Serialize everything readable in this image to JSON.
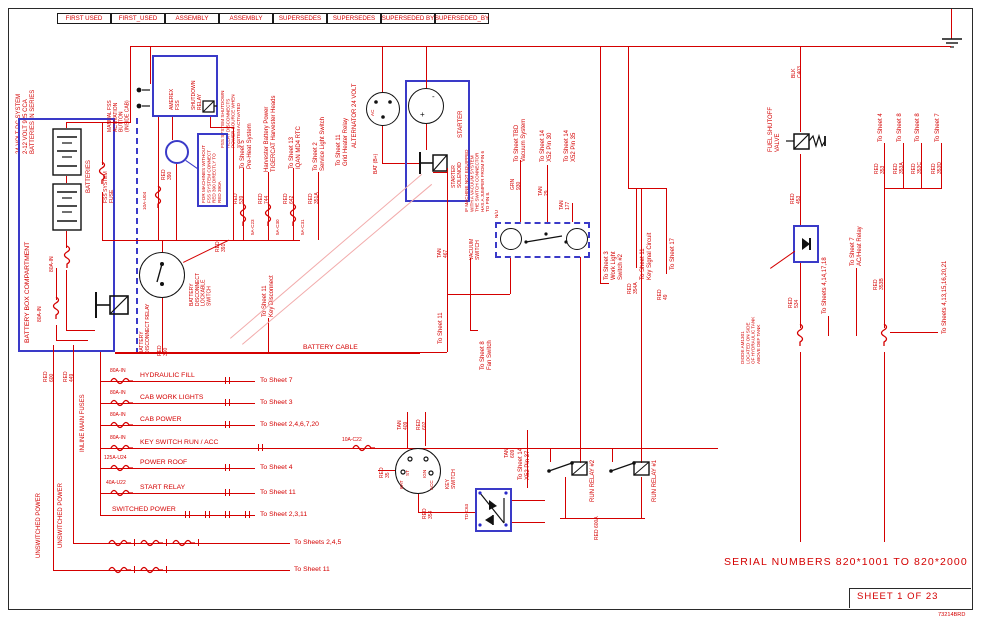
{
  "doc": {
    "serial": "SERIAL NUMBERS 820*1001 TO 820*2000",
    "sheet": "SHEET 1 OF 23",
    "number": "73214BRD"
  },
  "header": {
    "cells": [
      "FIRST USED",
      "FIRST_USED",
      "ASSEMBLY",
      "ASSEMBLY",
      "SUPERSEDES",
      "SUPERSEDES",
      "SUPERSEDED BY",
      "SUPERSEDED_BY"
    ]
  },
  "left": {
    "system": "24 VOLT DC SYSTEM\n2-12 VOLT 925 CCA\nBATTERIES IN SERIES",
    "battery_box": "BATTERY BOX COMPARTMENT",
    "batteries": "BATTERIES",
    "fss_fuse": "FSS SYSTEM\nFUSE",
    "fuse1": "80A-IN",
    "fuse2": "80A-IN",
    "disc_relay": "BATTERY\nDISCONNECT RELAY",
    "disc_switch": "BATTERY\nDISCONNECT\nLOCKABLE\nSWITCH",
    "key_disconnect": "To Sheet 11\nKey Disconnect",
    "battery_cable": "BATTERY CABLE",
    "unswitched1": "UNSWITCHED POWER",
    "unswitched2": "UNSWITCHED POWER",
    "inline_fuses": "INLINE MAIN FUSES",
    "red600": "RED\n600",
    "red449": "RED\n449"
  },
  "fss": {
    "manual_button": "MANUAL FSS\nACTIVATION\nBUTTON\n(INSIDE CAB)",
    "amerex": "AMEREX\nFSS",
    "shutdown_relay": "SHUTDOWN\nRELAY",
    "side_note": "FSS SYSTEM SHUTDOWN\nRELAY DISCONNECTS\nPOWER SOURCE WHEN\nSYSTEM ACTIVATED",
    "box_note": "FOR MACHINES WITHOUT\nFSS SYSTEM CONNECT\nRED 390 DIRECTLY TO\nRED 390A",
    "fuse": "10A-U04",
    "red390": "RED\n390"
  },
  "exits_top": [
    {
      "label": "To Sheet 5\nPre-Heat System",
      "wire": "RED\n539",
      "fuse": "5A-C23"
    },
    {
      "label": "Harvester Battery Power\nTIGERCAT Harvester Heads",
      "wire": "RED\n744",
      "fuse": "5A-C30"
    },
    {
      "label": "To Sheet 13\nIQAN MD4 RTC",
      "wire": "RED\n642",
      "fuse": "5A-C31"
    },
    {
      "label": "To Sheet 2\nService Light Switch",
      "wire": "RED\n351A",
      "fuse": ""
    }
  ],
  "engine": {
    "grid_heater": "To Sheet 11\nGrid Heater Relay",
    "alternator": "ALTERNATOR 24 VOLT",
    "bat": "BAT (B+)",
    "ac": "AC",
    "minus": "-",
    "plus": "+",
    "starter": "STARTER",
    "solenoid": "STARTER\nSOLENOID",
    "tan467": "TAN\n467",
    "to_sheet11": "To Sheet 11",
    "red391": "RED\n391"
  },
  "vacuum": {
    "note": "IF MACHINE NOT EQUIPPED\nWITH A VACUUM SYSTEM\nTHE SWITCH CONNECTOR\nHAS A JUMPER FROM PIN 6\nTO PIN 8.",
    "switch": "VACUUM\nSWITCH",
    "nu": "N/U",
    "tbd": "To Sheet TBD\nVacuum System",
    "grn930": "GRN\n930",
    "pin30": "To Sheet 14\nX52 Pin 30",
    "tan29": "TAN\n29",
    "pin35": "To Sheet 14\nX52 Pin 35",
    "tan177": "TAN\n177",
    "fan": "To Sheet 8\nFan Switch"
  },
  "mid_exits": [
    {
      "label": "To Sheet 3\nWork Light\nSwitch #2",
      "wire": ""
    },
    {
      "label": "To Sheet 11\nKey Signal Circuit",
      "wire": "RED\n354A"
    },
    {
      "label": "To Sheet 17",
      "wire": "RED\n49"
    }
  ],
  "fuel": {
    "valve": "FUEL SHUTOFF\nVALVE",
    "blk": "BLK\nC403",
    "red453": "RED\n453",
    "red534": "RED\n534",
    "diode_note": "DIODE AM1301\nLOCATED ON SIDE\nOF HYDRAULIC TANK\nABOVE DEF TANK",
    "sheets_a": "To Sheets 4,14,17,18",
    "ac_heat": "To Sheet 7\nAC/Heat Relay"
  },
  "exits_right": [
    {
      "label": "To Sheet 4",
      "wire": "RED\n353"
    },
    {
      "label": "To Sheet 8",
      "wire": "RED\n353A"
    },
    {
      "label": "To Sheet 8",
      "wire": "RED\n353C"
    },
    {
      "label": "To Sheet 7",
      "wire": "RED\n353D"
    }
  ],
  "right": {
    "red353b": "RED\n353B",
    "sheets_b": "To Sheets 4,13,15,16,20,21"
  },
  "fuses": {
    "rows": [
      {
        "amp": "80A-IN",
        "name": "HYDRAULIC FILL",
        "dest": "To Sheet 7"
      },
      {
        "amp": "80A-IN",
        "name": "CAB WORK LIGHTS",
        "dest": "To Sheet 3"
      },
      {
        "amp": "80A-IN",
        "name": "CAB POWER",
        "dest": "To Sheet 2,4,6,7,20"
      },
      {
        "amp": "80A-IN",
        "name": "KEY SWITCH RUN / ACC",
        "dest": ""
      },
      {
        "amp": "125A-U24",
        "name": "POWER ROOF",
        "dest": "To Sheet 4"
      },
      {
        "amp": "40A-U22",
        "name": "START RELAY",
        "dest": "To Sheet 11"
      },
      {
        "amp": "",
        "name": "SWITCHED POWER",
        "dest": "To Sheet 2,3,11"
      }
    ],
    "inline_fuse": "10A-C22",
    "bottom": [
      {
        "dest": "To Sheets 2,4,5"
      },
      {
        "dest": "To Sheet 11"
      }
    ]
  },
  "key": {
    "label": "KEY\nSWITCH",
    "bat": "BAT",
    "st": "ST",
    "ign": "IGN",
    "acc": "ACC",
    "tan409": "TAN\n409",
    "red602": "RED\n602",
    "red35": "RED\n35",
    "red354": "RED\n354",
    "diode": "TD-C63",
    "pin37": "To Sheet 14\nX52 Pin 37",
    "tan609": "TAN\n609"
  },
  "relays": {
    "r1": "RUN RELAY #1",
    "r2": "RUN RELAY #2",
    "red600a": "RED 600A"
  }
}
